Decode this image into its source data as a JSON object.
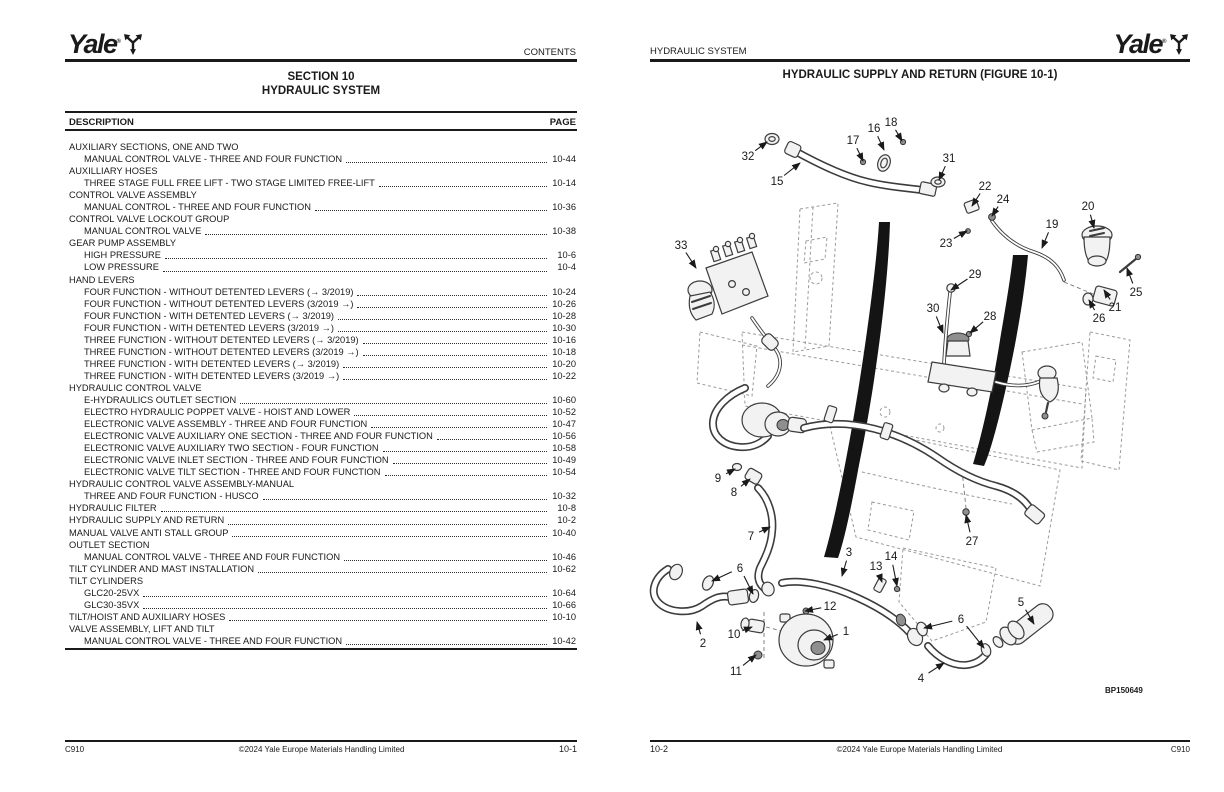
{
  "brand": {
    "word": "Yale",
    "reg": "®"
  },
  "left_page": {
    "header_right": "CONTENTS",
    "section_line1": "SECTION 10",
    "section_line2": "HYDRAULIC SYSTEM",
    "col_description": "DESCRIPTION",
    "col_page": "PAGE",
    "toc": [
      {
        "text": "AUXILIARY SECTIONS, ONE AND TWO",
        "page": "",
        "indent": 0
      },
      {
        "text": "MANUAL CONTROL VALVE - THREE AND FOUR FUNCTION",
        "page": "10-44",
        "indent": 1
      },
      {
        "text": "AUXILLIARY HOSES",
        "page": "",
        "indent": 0
      },
      {
        "text": "THREE STAGE FULL FREE LIFT - TWO STAGE LIMITED FREE-LIFT",
        "page": "10-14",
        "indent": 1
      },
      {
        "text": "CONTROL VALVE ASSEMBLY",
        "page": "",
        "indent": 0
      },
      {
        "text": "MANUAL CONTROL - THREE AND FOUR FUNCTION",
        "page": "10-36",
        "indent": 1
      },
      {
        "text": "CONTROL VALVE LOCKOUT GROUP",
        "page": "",
        "indent": 0
      },
      {
        "text": "MANUAL CONTROL VALVE",
        "page": "10-38",
        "indent": 1
      },
      {
        "text": "GEAR PUMP ASSEMBLY",
        "page": "",
        "indent": 0
      },
      {
        "text": "HIGH PRESSURE",
        "page": "10-6",
        "indent": 1
      },
      {
        "text": "LOW PRESSURE",
        "page": "10-4",
        "indent": 1
      },
      {
        "text": "HAND LEVERS",
        "page": "",
        "indent": 0
      },
      {
        "text": "FOUR FUNCTION - WITHOUT DETENTED LEVERS (→ 3/2019)",
        "page": "10-24",
        "indent": 1
      },
      {
        "text": "FOUR FUNCTION - WITHOUT DETENTED LEVERS (3/2019 →)",
        "page": "10-26",
        "indent": 1
      },
      {
        "text": "FOUR FUNCTION - WITH DETENTED LEVERS (→ 3/2019)",
        "page": "10-28",
        "indent": 1
      },
      {
        "text": "FOUR FUNCTION - WITH DETENTED LEVERS (3/2019 →)",
        "page": "10-30",
        "indent": 1
      },
      {
        "text": "THREE FUNCTION - WITHOUT DETENTED LEVERS (→ 3/2019)",
        "page": "10-16",
        "indent": 1
      },
      {
        "text": "THREE FUNCTION - WITHOUT DETENTED LEVERS (3/2019 →)",
        "page": "10-18",
        "indent": 1
      },
      {
        "text": "THREE FUNCTION - WITH DETENTED LEVERS (→ 3/2019)",
        "page": "10-20",
        "indent": 1
      },
      {
        "text": "THREE FUNCTION - WITH DETENTED LEVERS (3/2019 →)",
        "page": "10-22",
        "indent": 1
      },
      {
        "text": "HYDRAULIC CONTROL VALVE",
        "page": "",
        "indent": 0
      },
      {
        "text": "E-HYDRAULICS OUTLET SECTION",
        "page": "10-60",
        "indent": 1
      },
      {
        "text": "ELECTRO HYDRAULIC POPPET VALVE - HOIST AND LOWER",
        "page": "10-52",
        "indent": 1
      },
      {
        "text": "ELECTRONIC VALVE ASSEMBLY - THREE AND FOUR FUNCTION",
        "page": "10-47",
        "indent": 1
      },
      {
        "text": "ELECTRONIC VALVE AUXILIARY ONE SECTION - THREE AND FOUR FUNCTION",
        "page": "10-56",
        "indent": 1
      },
      {
        "text": "ELECTRONIC VALVE AUXILIARY TWO SECTION - FOUR FUNCTION",
        "page": "10-58",
        "indent": 1
      },
      {
        "text": "ELECTRONIC VALVE INLET SECTION - THREE AND FOUR FUNCTION",
        "page": "10-49",
        "indent": 1
      },
      {
        "text": "ELECTRONIC VALVE TILT SECTION - THREE AND FOUR FUNCTION",
        "page": "10-54",
        "indent": 1
      },
      {
        "text": "HYDRAULIC CONTROL VALVE ASSEMBLY-MANUAL",
        "page": "",
        "indent": 0
      },
      {
        "text": "THREE AND FOUR FUNCTION - HUSCO",
        "page": "10-32",
        "indent": 1
      },
      {
        "text": "HYDRAULIC FILTER",
        "page": "10-8",
        "indent": 0
      },
      {
        "text": "HYDRAULIC SUPPLY AND RETURN",
        "page": "10-2",
        "indent": 0
      },
      {
        "text": "MANUAL VALVE ANTI STALL GROUP",
        "page": "10-40",
        "indent": 0
      },
      {
        "text": "OUTLET SECTION",
        "page": "",
        "indent": 0
      },
      {
        "text": "MANUAL CONTROL VALVE - THREE AND F0UR FUNCTION",
        "page": "10-46",
        "indent": 1
      },
      {
        "text": "TILT CYLINDER AND MAST INSTALLATION",
        "page": "10-62",
        "indent": 0
      },
      {
        "text": "TILT CYLINDERS",
        "page": "",
        "indent": 0
      },
      {
        "text": "GLC20-25VX",
        "page": "10-64",
        "indent": 1
      },
      {
        "text": "GLC30-35VX",
        "page": "10-66",
        "indent": 1
      },
      {
        "text": "TILT/HOIST AND AUXILIARY HOSES",
        "page": "10-10",
        "indent": 0
      },
      {
        "text": "VALVE ASSEMBLY, LIFT AND TILT",
        "page": "",
        "indent": 0
      },
      {
        "text": "MANUAL CONTROL VALVE - THREE AND FOUR FUNCTION",
        "page": "10-42",
        "indent": 1
      }
    ],
    "footer": {
      "left": "C910",
      "center": "©2024 Yale Europe Materials Handling Limited",
      "right": "10-1"
    }
  },
  "right_page": {
    "header_left": "HYDRAULIC SYSTEM",
    "title": "HYDRAULIC SUPPLY AND RETURN (FIGURE 10-1)",
    "figure_code": "BP150649",
    "callouts": [
      {
        "n": "1",
        "x": 846,
        "y": 631,
        "t": [
          [
            824,
            640
          ]
        ]
      },
      {
        "n": "2",
        "x": 703,
        "y": 643,
        "t": [
          [
            697,
            622
          ]
        ]
      },
      {
        "n": "3",
        "x": 849,
        "y": 552,
        "t": [
          [
            842,
            576
          ]
        ]
      },
      {
        "n": "4",
        "x": 921,
        "y": 678,
        "t": [
          [
            944,
            663
          ]
        ]
      },
      {
        "n": "5",
        "x": 1021,
        "y": 602,
        "t": [
          [
            1034,
            624
          ]
        ]
      },
      {
        "n": "6",
        "x": 740,
        "y": 568,
        "t": [
          [
            712,
            581
          ],
          [
            753,
            594
          ]
        ]
      },
      {
        "n": "6",
        "x": 961,
        "y": 619,
        "t": [
          [
            924,
            628
          ],
          [
            984,
            648
          ]
        ]
      },
      {
        "n": "7",
        "x": 751,
        "y": 536,
        "t": [
          [
            770,
            527
          ]
        ]
      },
      {
        "n": "8",
        "x": 734,
        "y": 492,
        "t": [
          [
            750,
            479
          ]
        ]
      },
      {
        "n": "9",
        "x": 718,
        "y": 478,
        "t": [
          [
            735,
            469
          ]
        ]
      },
      {
        "n": "10",
        "x": 734,
        "y": 634,
        "t": [
          [
            752,
            627
          ]
        ]
      },
      {
        "n": "11",
        "x": 736,
        "y": 671,
        "t": [
          [
            756,
            655
          ]
        ]
      },
      {
        "n": "12",
        "x": 830,
        "y": 606,
        "t": [
          [
            805,
            611
          ]
        ]
      },
      {
        "n": "13",
        "x": 876,
        "y": 566,
        "t": [
          [
            882,
            582
          ]
        ]
      },
      {
        "n": "14",
        "x": 891,
        "y": 556,
        "t": [
          [
            897,
            586
          ]
        ]
      },
      {
        "n": "15",
        "x": 777,
        "y": 181,
        "t": [
          [
            800,
            163
          ]
        ]
      },
      {
        "n": "16",
        "x": 874,
        "y": 128,
        "t": [
          [
            884,
            150
          ]
        ]
      },
      {
        "n": "17",
        "x": 853,
        "y": 140,
        "t": [
          [
            863,
            161
          ]
        ]
      },
      {
        "n": "18",
        "x": 891,
        "y": 122,
        "t": [
          [
            902,
            141
          ]
        ]
      },
      {
        "n": "19",
        "x": 1052,
        "y": 224,
        "t": [
          [
            1042,
            248
          ]
        ]
      },
      {
        "n": "20",
        "x": 1088,
        "y": 206,
        "t": [
          [
            1094,
            228
          ]
        ]
      },
      {
        "n": "21",
        "x": 1115,
        "y": 307,
        "t": [
          [
            1104,
            290
          ]
        ]
      },
      {
        "n": "22",
        "x": 985,
        "y": 186,
        "t": [
          [
            972,
            206
          ]
        ]
      },
      {
        "n": "23",
        "x": 946,
        "y": 243,
        "t": [
          [
            967,
            231
          ]
        ]
      },
      {
        "n": "24",
        "x": 1003,
        "y": 199,
        "t": [
          [
            992,
            216
          ]
        ]
      },
      {
        "n": "25",
        "x": 1136,
        "y": 292,
        "t": [
          [
            1127,
            268
          ]
        ]
      },
      {
        "n": "26",
        "x": 1099,
        "y": 318,
        "t": [
          [
            1089,
            300
          ]
        ]
      },
      {
        "n": "27",
        "x": 972,
        "y": 541,
        "t": [
          [
            966,
            515
          ]
        ]
      },
      {
        "n": "28",
        "x": 990,
        "y": 316,
        "t": [
          [
            970,
            333
          ]
        ]
      },
      {
        "n": "29",
        "x": 975,
        "y": 274,
        "t": [
          [
            951,
            290
          ]
        ]
      },
      {
        "n": "30",
        "x": 933,
        "y": 308,
        "t": [
          [
            943,
            333
          ]
        ]
      },
      {
        "n": "31",
        "x": 949,
        "y": 158,
        "t": [
          [
            939,
            180
          ]
        ]
      },
      {
        "n": "32",
        "x": 748,
        "y": 156,
        "t": [
          [
            767,
            142
          ]
        ]
      },
      {
        "n": "33",
        "x": 681,
        "y": 245,
        "t": [
          [
            696,
            268
          ]
        ]
      }
    ],
    "footer": {
      "left": "10-2",
      "center": "©2024 Yale Europe Materials Handling Limited",
      "right": "C910"
    }
  }
}
